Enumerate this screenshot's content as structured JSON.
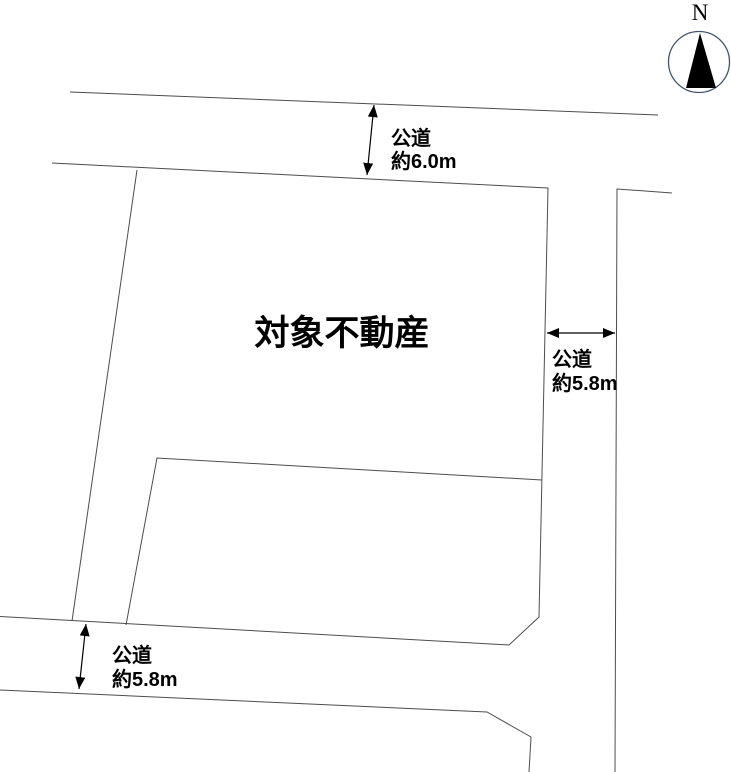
{
  "diagram": {
    "title": "site-plan",
    "plot": {
      "label": "対象不動産"
    },
    "compass": {
      "label": "N"
    },
    "dimensions": {
      "north_road": {
        "name": "公道",
        "width": "約6.0m"
      },
      "east_road": {
        "name": "公道",
        "width": "約5.8m"
      },
      "south_road": {
        "name": "公道",
        "width": "約5.8m"
      }
    },
    "colors": {
      "background": "#ffffff",
      "boundary_line": "#4d4d4d",
      "dimension_arrow": "#000000",
      "text": "#000000",
      "compass_circle": "#44546a",
      "compass_needle": "#000000"
    }
  }
}
